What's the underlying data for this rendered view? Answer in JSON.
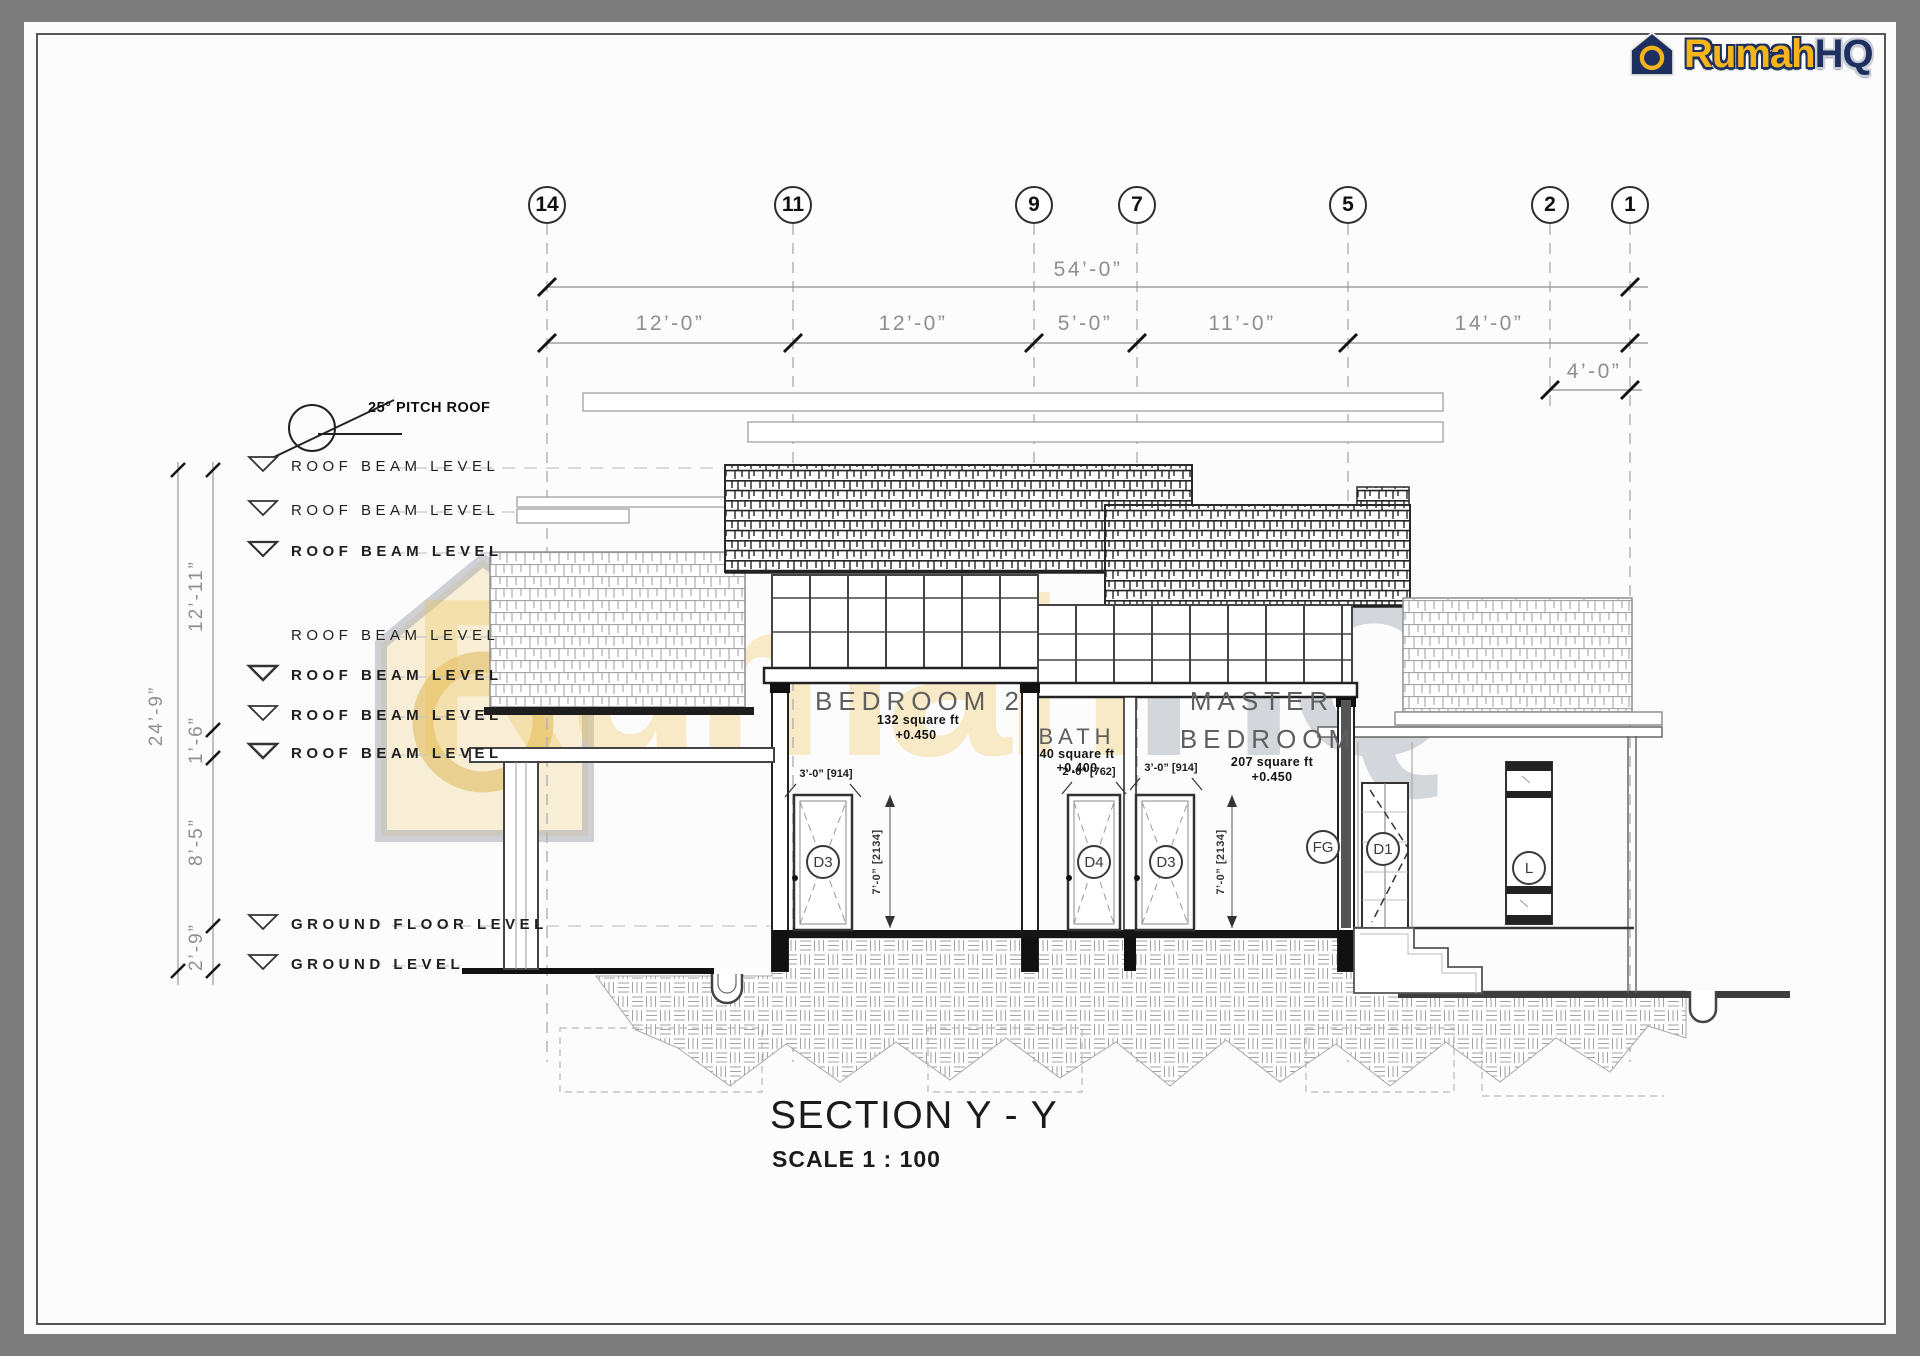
{
  "brand": {
    "primary": "Rumah",
    "secondary": "HQ",
    "primary_color": "#f4b41a",
    "secondary_color": "#1e3060"
  },
  "watermark": {
    "primary": "Rumah",
    "secondary": "HQ"
  },
  "grid_bubbles": [
    {
      "label": "14"
    },
    {
      "label": "11"
    },
    {
      "label": "9"
    },
    {
      "label": "7"
    },
    {
      "label": "5"
    },
    {
      "label": "2"
    },
    {
      "label": "1"
    }
  ],
  "top_dims": {
    "overall": "54’-0”",
    "seg1": "12’-0”",
    "seg2": "12’-0”",
    "seg3": "5’-0”",
    "seg4": "11’-0”",
    "seg5": "14’-0”",
    "offset": "4’-0”"
  },
  "roof_note": "25° PITCH ROOF",
  "levels": {
    "rbl": "ROOF BEAM LEVEL",
    "gfl": "GROUND FLOOR LEVEL",
    "gl": "GROUND  LEVEL"
  },
  "left_dims": {
    "overall": "24’-9”",
    "d1": "12’-11”",
    "d2": "1’-6”",
    "d3": "8’-5”",
    "d4": "2’-9”"
  },
  "rooms": {
    "bedroom2": {
      "name": "BEDROOM 2",
      "area": "132 square ft",
      "level": "+0.450"
    },
    "bath": {
      "name": "BATH",
      "area": "40 square ft",
      "level": "+0.400"
    },
    "master": {
      "name_line1": "MASTER",
      "name_line2": "BEDROOM",
      "area": "207 square ft",
      "level": "+0.450"
    }
  },
  "openings": {
    "d3a": {
      "tag": "D3",
      "width": "3’-0” [914]"
    },
    "d4": {
      "tag": "D4",
      "width": "2’-6” [762]"
    },
    "d3b": {
      "tag": "D3",
      "width": "3’-0” [914]"
    },
    "fg": {
      "tag": "FG"
    },
    "d1": {
      "tag": "D1"
    },
    "l": {
      "tag": "L"
    },
    "height1": "7’-0” [2134]",
    "height2": "7’-0” [2134]"
  },
  "title": {
    "name": "SECTION Y - Y",
    "scale": "SCALE 1 : 100"
  }
}
